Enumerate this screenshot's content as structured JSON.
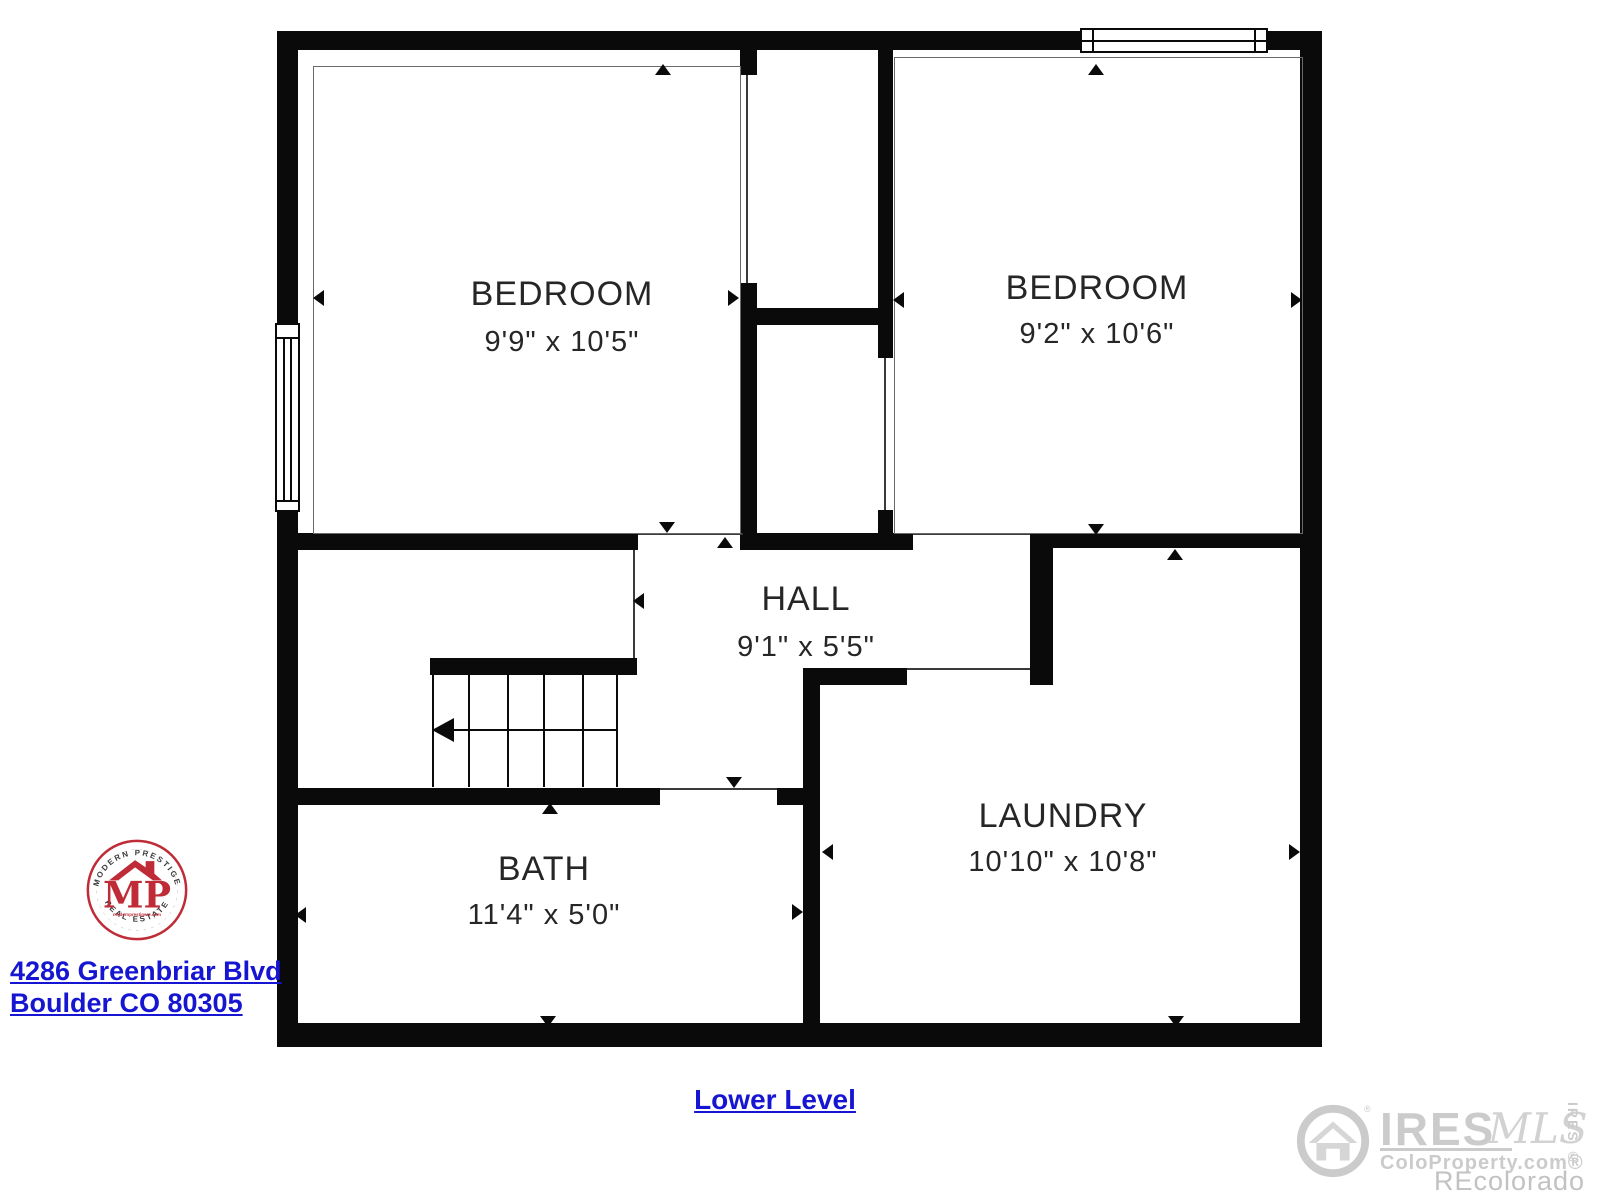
{
  "floorplan": {
    "wall_color": "#0a0a0a",
    "rooms": [
      {
        "name": "BEDROOM",
        "dims": "9'9\" x 10'5\""
      },
      {
        "name": "BEDROOM",
        "dims": "9'2\" x 10'6\""
      },
      {
        "name": "HALL",
        "dims": "9'1\" x 5'5\""
      },
      {
        "name": "BATH",
        "dims": "11'4\" x 5'0\""
      },
      {
        "name": "LAUNDRY",
        "dims": "10'10\" x 10'8\""
      }
    ]
  },
  "agency_logo": {
    "top_arc": "MODERN PRESTIGE",
    "bottom_arc": "REAL ESTATE",
    "monogram": "MP",
    "website": "modernprestigere.com",
    "ring_color": "#bf2b36"
  },
  "listing": {
    "address_line1": "4286 Greenbriar Blvd",
    "address_line2": "Boulder CO 80305",
    "level_label": "Lower Level",
    "link_color": "#1515d2"
  },
  "watermark": {
    "brand": "IRES",
    "brand_registered": "®",
    "brand_script": "MLS",
    "site": "ColoProperty.com®",
    "vertical_label": "IRES ©",
    "attribution": "REcolorado",
    "color": "#cbcbcb"
  }
}
